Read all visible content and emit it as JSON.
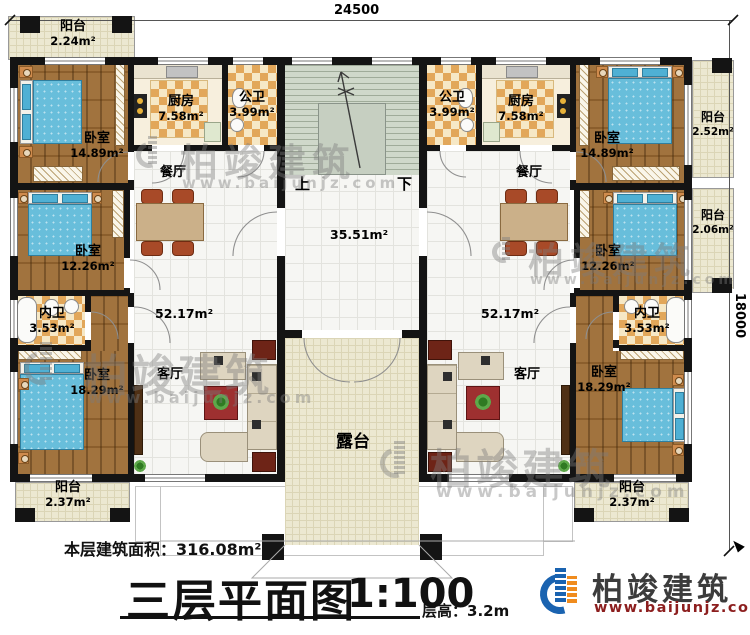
{
  "dimensions": {
    "top": "24500",
    "right": "18000"
  },
  "stairs": {
    "up": "上",
    "down": "下"
  },
  "rooms": {
    "balcony_tl": {
      "n": "阳台",
      "a": "2.24m²"
    },
    "bedroom_tl": {
      "n": "卧室",
      "a": "14.89m²"
    },
    "kitchen_l": {
      "n": "厨房",
      "a": "7.58m²"
    },
    "bath_pub_l": {
      "n": "公卫",
      "a": "3.99m²"
    },
    "dining_l": {
      "n": "餐厅"
    },
    "bedroom_ml": {
      "n": "卧室",
      "a": "12.26m²"
    },
    "bath_pri_l": {
      "n": "内卫",
      "a": "3.53m²"
    },
    "bedroom_bl": {
      "n": "卧室",
      "a": "18.29m²"
    },
    "living_l": {
      "n": "客厅",
      "a": "52.17m²"
    },
    "balcony_bl": {
      "n": "阳台",
      "a": "2.37m²"
    },
    "bath_pub_r": {
      "n": "公卫",
      "a": "3.99m²"
    },
    "kitchen_r": {
      "n": "厨房",
      "a": "7.58m²"
    },
    "bedroom_tr": {
      "n": "卧室",
      "a": "14.89m²"
    },
    "balcony_r1": {
      "n": "阳台",
      "a": "2.52m²"
    },
    "dining_r": {
      "n": "餐厅"
    },
    "bedroom_mr": {
      "n": "卧室",
      "a": "12.26m²"
    },
    "balcony_r2": {
      "n": "阳台",
      "a": "2.06m²"
    },
    "bath_pri_r": {
      "n": "内卫",
      "a": "3.53m²"
    },
    "bedroom_br": {
      "n": "卧室",
      "a": "18.29m²"
    },
    "living_r": {
      "n": "客厅",
      "a": "52.17m²"
    },
    "balcony_br": {
      "n": "阳台",
      "a": "2.37m²"
    },
    "hall": {
      "a": "35.51m²"
    },
    "terrace": {
      "n": "露台"
    }
  },
  "footer": {
    "floor_area_label": "本层建筑面积：",
    "floor_area_value": "316.08m²",
    "title": "三层平面图",
    "scale": "1:100",
    "floor_height_label": "层高：",
    "floor_height_value": "3.2m"
  },
  "brand": {
    "name": "柏竣建筑",
    "url": "www.baijunjz.com"
  },
  "watermark": {
    "name": "柏竣建筑",
    "url": "www.baijunjz.com"
  },
  "colors": {
    "accent_blue": "#1a63b0",
    "accent_orange": "#f08c1e",
    "url_red": "#8c1e1e"
  }
}
